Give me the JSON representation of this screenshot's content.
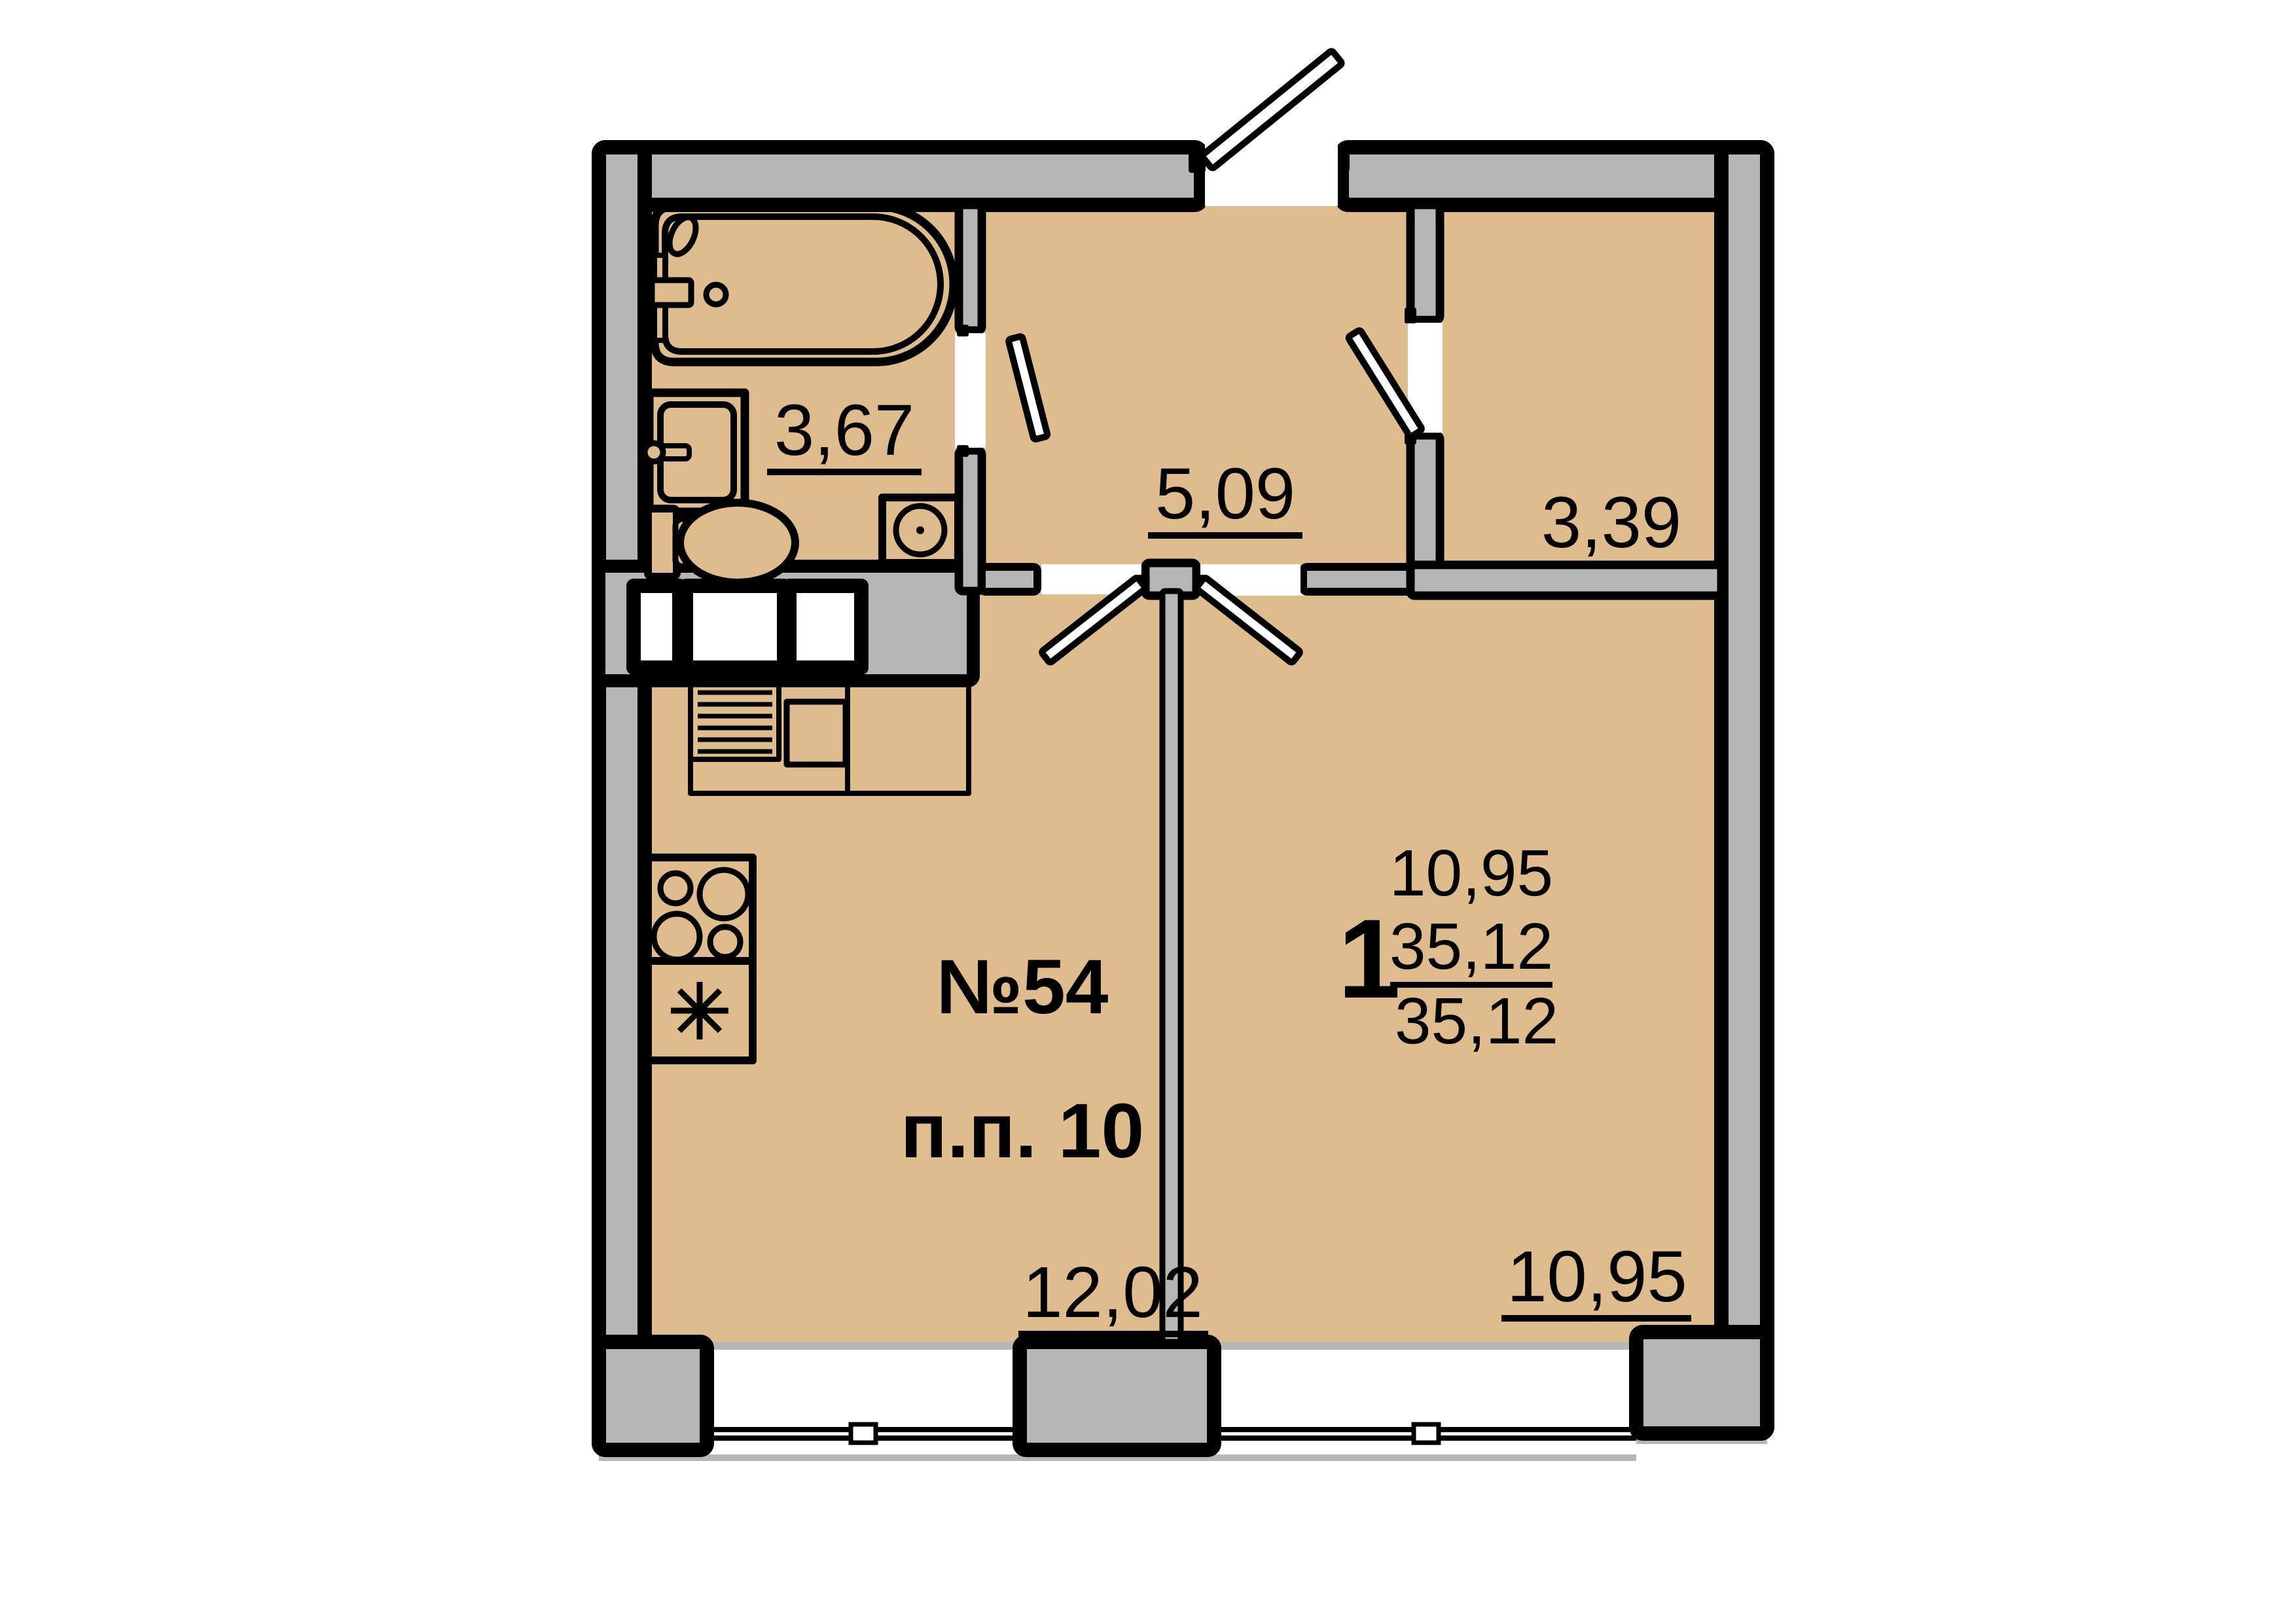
{
  "plan": {
    "apartment": {
      "number": "№54",
      "position": "п.п. 10",
      "rooms_count": "1",
      "areas": [
        "10,95",
        "35,12",
        "35,12"
      ]
    },
    "rooms": {
      "bathroom_area": "3,67",
      "hallway_area": "5,09",
      "storage_area": "3,39",
      "kitchen_area": "12,02",
      "living_room_area": "10,95"
    },
    "colors": {
      "floor": "#dfbc8e",
      "wall": "#b6b6b6",
      "line": "#000000"
    }
  }
}
